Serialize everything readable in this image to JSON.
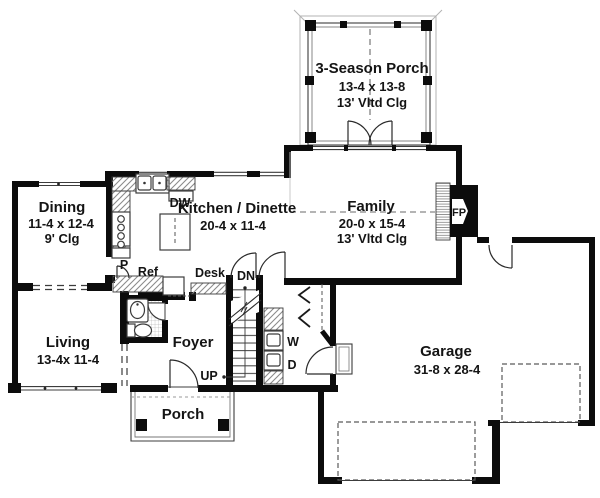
{
  "rooms": {
    "porch3": {
      "name": "3-Season Porch",
      "dim": "13-4 x 13-8",
      "clg": "13' Vltd Clg"
    },
    "family": {
      "name": "Family",
      "dim": "20-0 x 15-4",
      "clg": "13' Vltd Clg"
    },
    "kitchen": {
      "name": "Kitchen / Dinette",
      "dim": "20-4 x 11-4"
    },
    "dining": {
      "name": "Dining",
      "dim": "11-4 x 12-4",
      "clg": "9' Clg"
    },
    "living": {
      "name": "Living",
      "dim": "13-4x 11-4"
    },
    "foyer": {
      "name": "Foyer"
    },
    "porch": {
      "name": "Porch"
    },
    "garage": {
      "name": "Garage",
      "dim": "31-8 x 28-4"
    }
  },
  "labels": {
    "dw": "DW",
    "pantry": "P",
    "ref": "Ref",
    "desk": "Desk",
    "dn": "DN",
    "up": "UP",
    "washer": "W",
    "dryer": "D",
    "fireplace": "FP"
  },
  "colors": {
    "wall": "#0c0c0c",
    "background": "#ffffff",
    "hatch": "#8b8b8b"
  }
}
